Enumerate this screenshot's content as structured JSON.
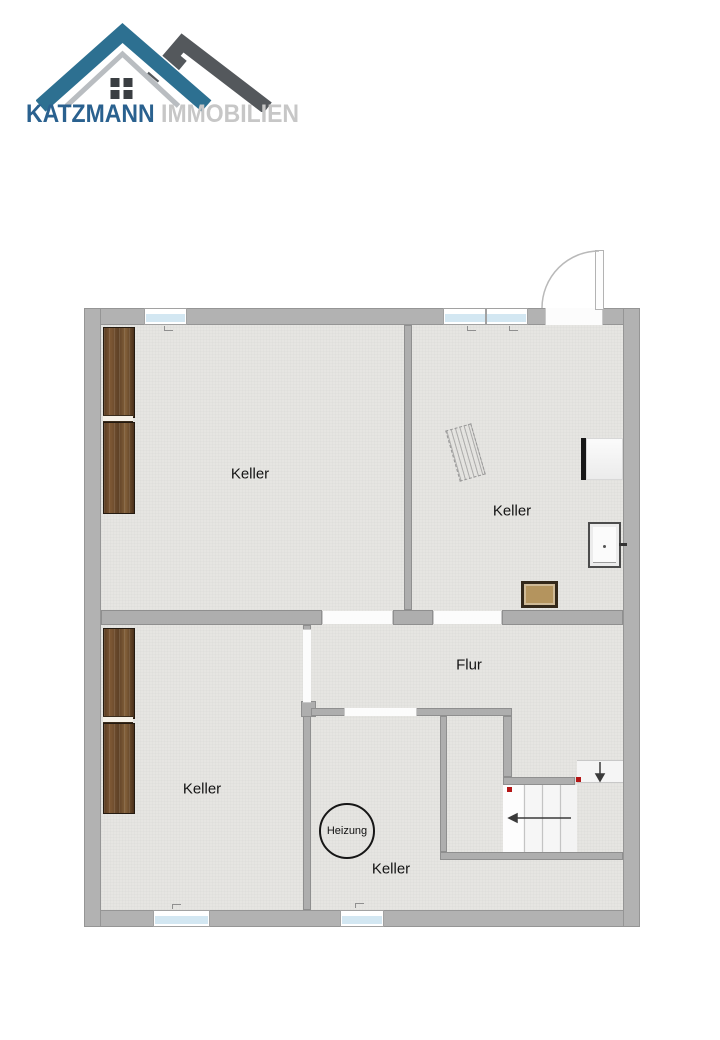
{
  "logo": {
    "brand_primary": "KATZMANN",
    "brand_secondary": "IMMOBILIEN",
    "colors": {
      "brand_primary": "#2a618f",
      "brand_secondary": "#c7c7c7",
      "roof_blue": "#2d7091",
      "roof_dark": "#54585c",
      "roof_silver": "#b9bdc1"
    }
  },
  "floor_plan": {
    "rooms": [
      {
        "id": "keller-top-left",
        "label": "Keller"
      },
      {
        "id": "keller-top-right",
        "label": "Keller"
      },
      {
        "id": "keller-bottom-left",
        "label": "Keller"
      },
      {
        "id": "keller-bottom-middle",
        "label": "Keller"
      },
      {
        "id": "flur",
        "label": "Flur"
      }
    ],
    "heating": {
      "label": "Heizung",
      "shape": "circle"
    },
    "fixtures": [
      {
        "id": "shelf-top-left",
        "type": "wood-shelf-pair"
      },
      {
        "id": "shelf-bottom-left",
        "type": "wood-shelf-pair"
      },
      {
        "id": "drying-rack",
        "type": "hatched-rack"
      },
      {
        "id": "appliance",
        "type": "white-box-black-edge"
      },
      {
        "id": "wall-hatch",
        "type": "framed-panel"
      },
      {
        "id": "crate",
        "type": "wooden-crate"
      },
      {
        "id": "staircase",
        "type": "stairs-with-landing"
      },
      {
        "id": "entry-door",
        "type": "swing-door-top-right"
      }
    ],
    "colors": {
      "wall": "#b2b2b2",
      "floor": "#e6e5e2",
      "window_glass": "#d3e7f2",
      "wood": "#6b4a2c",
      "stair_marker": "#b41616"
    }
  }
}
